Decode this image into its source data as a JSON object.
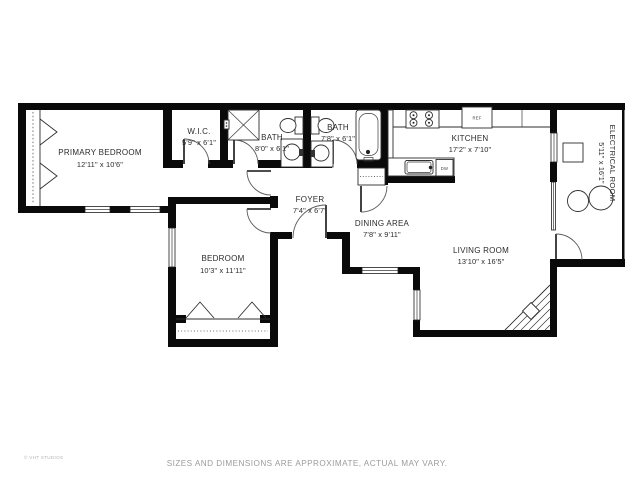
{
  "plan": {
    "rooms": [
      {
        "id": "primary-bedroom",
        "name": "PRIMARY BEDROOM",
        "dims": "12'11\" x 10'6\""
      },
      {
        "id": "wic",
        "name": "W.I.C.",
        "dims": "5'9\" x 6'1\""
      },
      {
        "id": "bath-1",
        "name": "BATH",
        "dims": "8'0\" x 6'1\""
      },
      {
        "id": "bath-2",
        "name": "BATH",
        "dims": "7'8\" x 6'1\""
      },
      {
        "id": "kitchen",
        "name": "KITCHEN",
        "dims": "17'2\" x 7'10\""
      },
      {
        "id": "electrical-room",
        "name": "ELECTRICAL ROOM",
        "dims": "5'11\" x 16'1\""
      },
      {
        "id": "foyer",
        "name": "FOYER",
        "dims": "7'4\" x 6'7\""
      },
      {
        "id": "dining-area",
        "name": "DINING AREA",
        "dims": "7'8\" x 9'11\""
      },
      {
        "id": "living-room",
        "name": "LIVING ROOM",
        "dims": "13'10\" x 16'5\""
      },
      {
        "id": "bedroom",
        "name": "BEDROOM",
        "dims": "10'3\" x 11'11\""
      }
    ],
    "appliances": {
      "refrigerator": "REF",
      "dishwasher": "DW"
    },
    "disclaimer": "SIZES AND DIMENSIONS ARE APPROXIMATE, ACTUAL MAY VARY.",
    "copyright": "© VHT STUDIOS",
    "colors": {
      "wall": "#000000",
      "line": "#3a3a3a",
      "label": "#2b2b2b",
      "muted": "#9b9b9b",
      "background": "#ffffff"
    }
  }
}
